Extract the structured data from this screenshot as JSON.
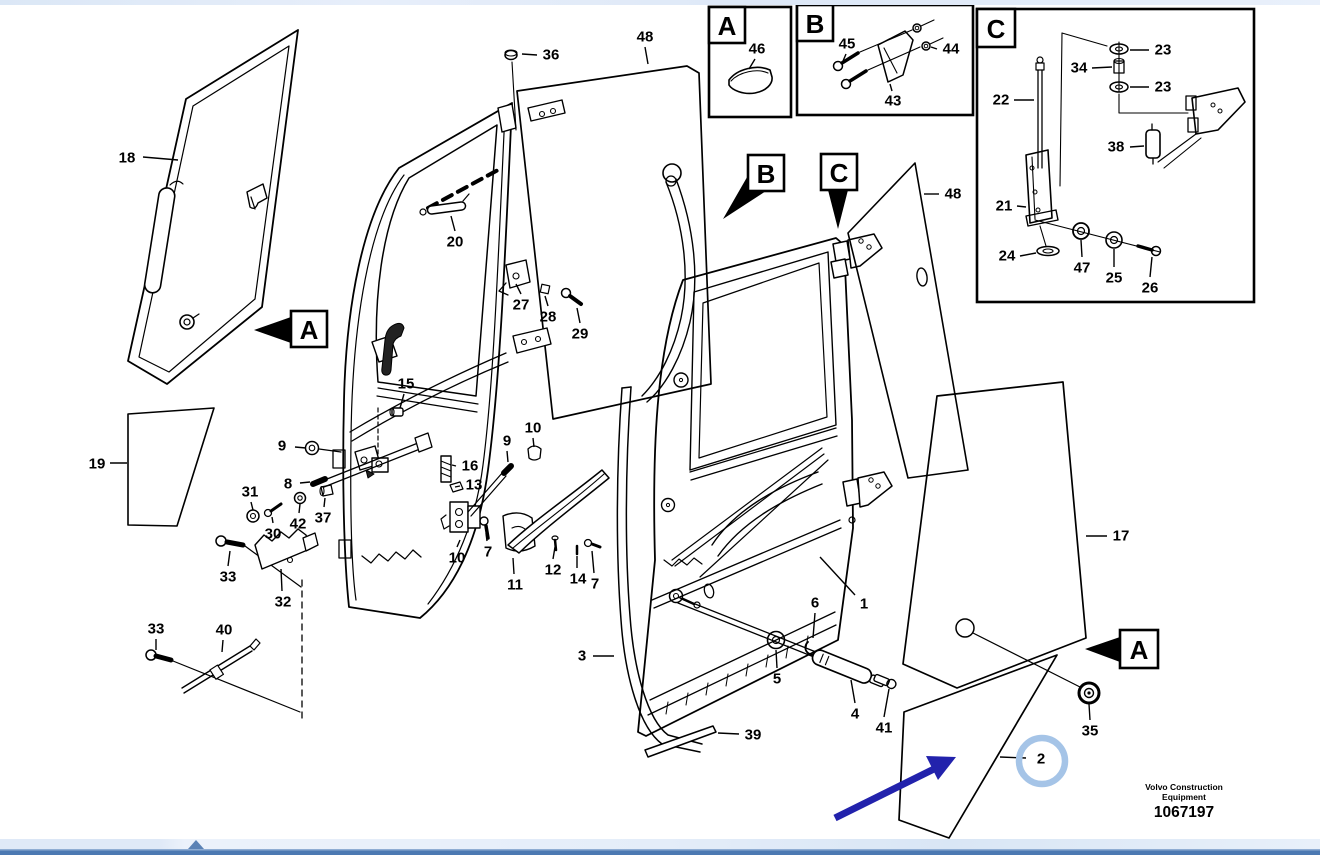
{
  "title": "Door assembly exploded parts diagram",
  "footer": {
    "brand_line1": "Volvo Construction",
    "brand_line2": "Equipment",
    "figure_number": "1067197"
  },
  "colors": {
    "line_art": "#000000",
    "highlight_arrow": "#2222AC",
    "highlight_circle": "#A5C4E7",
    "top_strip": "#DEE9F7",
    "scroll_band": "#E3ECF8",
    "scroll_bar": "#4C79B2",
    "scroll_triangle": "#5B82B5"
  },
  "inset_boxes": [
    {
      "id": "A",
      "letter": "A",
      "frame": [
        709,
        7,
        82,
        110
      ],
      "letter_box": [
        709,
        7,
        36,
        36
      ]
    },
    {
      "id": "B",
      "letter": "B",
      "frame": [
        797,
        5,
        176,
        110
      ],
      "letter_box": [
        797,
        5,
        36,
        36
      ]
    },
    {
      "id": "C",
      "letter": "C",
      "frame": [
        977,
        9,
        277,
        293
      ],
      "letter_box": [
        977,
        9,
        38,
        38
      ]
    }
  ],
  "ref_markers": [
    {
      "id": "A-side",
      "letter": "A",
      "box": [
        291,
        311,
        36,
        36
      ],
      "arrow": "291,317 291,343 254,330"
    },
    {
      "id": "B-main",
      "letter": "B",
      "box": [
        748,
        155,
        36,
        36
      ],
      "arrow": "750,172 766,191 723,219"
    },
    {
      "id": "C-main",
      "letter": "C",
      "box": [
        821,
        154,
        36,
        36
      ],
      "arrow": "828,190 848,190 838,229"
    },
    {
      "id": "A-right",
      "letter": "A",
      "box": [
        1120,
        630,
        38,
        38
      ],
      "arrow": "1120,637 1120,662 1085,649"
    }
  ],
  "part_labels": [
    {
      "id": "18",
      "num": "18",
      "x": 127,
      "y": 158,
      "leader": [
        143,
        157,
        178,
        160
      ]
    },
    {
      "id": "19",
      "num": "19",
      "x": 97,
      "y": 464,
      "leader": [
        110,
        463,
        127,
        463
      ]
    },
    {
      "id": "36",
      "num": "36",
      "x": 551,
      "y": 55,
      "leader": [
        537,
        55,
        522,
        54
      ]
    },
    {
      "id": "48-top",
      "num": "48",
      "x": 645,
      "y": 37,
      "leader": [
        645,
        47,
        648,
        64
      ]
    },
    {
      "id": "20",
      "num": "20",
      "x": 455,
      "y": 242,
      "leader": [
        455,
        231,
        451,
        216
      ]
    },
    {
      "id": "27",
      "num": "27",
      "x": 521,
      "y": 305,
      "leader": [
        521,
        294,
        516,
        284
      ]
    },
    {
      "id": "28",
      "num": "28",
      "x": 548,
      "y": 317,
      "leader": [
        548,
        306,
        545,
        296
      ]
    },
    {
      "id": "29",
      "num": "29",
      "x": 580,
      "y": 334,
      "leader": [
        580,
        323,
        577,
        308
      ]
    },
    {
      "id": "15",
      "num": "15",
      "x": 406,
      "y": 384,
      "leader": [
        404,
        394,
        400,
        408
      ]
    },
    {
      "id": "9-left",
      "num": "9",
      "x": 282,
      "y": 446,
      "leader": [
        295,
        447,
        306,
        448
      ]
    },
    {
      "id": "8",
      "num": "8",
      "x": 288,
      "y": 484,
      "leader": [
        300,
        483,
        310,
        482
      ]
    },
    {
      "id": "31",
      "num": "31",
      "x": 250,
      "y": 492,
      "leader": [
        251,
        502,
        253,
        510
      ]
    },
    {
      "id": "30",
      "num": "30",
      "x": 273,
      "y": 534,
      "leader": [
        273,
        523,
        272,
        517
      ]
    },
    {
      "id": "42",
      "num": "42",
      "x": 298,
      "y": 524,
      "leader": [
        299,
        513,
        300,
        504
      ]
    },
    {
      "id": "37",
      "num": "37",
      "x": 323,
      "y": 518,
      "leader": [
        324,
        507,
        325,
        498
      ]
    },
    {
      "id": "16",
      "num": "16",
      "x": 470,
      "y": 466,
      "leader": [
        456,
        466,
        452,
        465
      ]
    },
    {
      "id": "13",
      "num": "13",
      "x": 474,
      "y": 485,
      "leader": [
        460,
        486,
        455,
        487
      ]
    },
    {
      "id": "9-right",
      "num": "9",
      "x": 507,
      "y": 441,
      "leader": [
        507,
        451,
        508,
        462
      ]
    },
    {
      "id": "10-top",
      "num": "10",
      "x": 533,
      "y": 428,
      "leader": [
        533,
        438,
        534,
        447
      ]
    },
    {
      "id": "10-bottom",
      "num": "10",
      "x": 457,
      "y": 558,
      "leader": [
        457,
        547,
        460,
        540
      ]
    },
    {
      "id": "7-a",
      "num": "7",
      "x": 488,
      "y": 552,
      "leader": [
        487,
        541,
        486,
        533
      ]
    },
    {
      "id": "11",
      "num": "11",
      "x": 515,
      "y": 585,
      "leader": [
        514,
        574,
        513,
        558
      ]
    },
    {
      "id": "12",
      "num": "12",
      "x": 553,
      "y": 570,
      "leader": [
        553,
        559,
        555,
        547
      ]
    },
    {
      "id": "14",
      "num": "14",
      "x": 578,
      "y": 579,
      "leader": [
        577,
        568,
        577,
        556
      ]
    },
    {
      "id": "7-b",
      "num": "7",
      "x": 595,
      "y": 584,
      "leader": [
        594,
        573,
        592,
        551
      ]
    },
    {
      "id": "33-top",
      "num": "33",
      "x": 228,
      "y": 577,
      "leader": [
        228,
        566,
        230,
        551
      ]
    },
    {
      "id": "32",
      "num": "32",
      "x": 283,
      "y": 602,
      "leader": [
        282,
        591,
        281,
        569
      ]
    },
    {
      "id": "33-bottom",
      "num": "33",
      "x": 156,
      "y": 629,
      "leader": [
        156,
        639,
        156,
        650
      ]
    },
    {
      "id": "40",
      "num": "40",
      "x": 224,
      "y": 630,
      "leader": [
        223,
        640,
        222,
        652
      ]
    },
    {
      "id": "3",
      "num": "3",
      "x": 582,
      "y": 656,
      "leader": [
        593,
        656,
        614,
        656
      ]
    },
    {
      "id": "5",
      "num": "5",
      "x": 777,
      "y": 679,
      "leader": [
        777,
        668,
        776,
        650
      ]
    },
    {
      "id": "6",
      "num": "6",
      "x": 815,
      "y": 603,
      "leader": [
        815,
        613,
        813,
        638
      ]
    },
    {
      "id": "1",
      "num": "1",
      "x": 864,
      "y": 604,
      "leader": [
        855,
        595,
        820,
        557
      ]
    },
    {
      "id": "4",
      "num": "4",
      "x": 855,
      "y": 714,
      "leader": [
        855,
        703,
        851,
        680
      ]
    },
    {
      "id": "41",
      "num": "41",
      "x": 884,
      "y": 728,
      "leader": [
        884,
        717,
        889,
        689
      ]
    },
    {
      "id": "39",
      "num": "39",
      "x": 753,
      "y": 735,
      "leader": [
        739,
        734,
        718,
        733
      ]
    },
    {
      "id": "48-right",
      "num": "48",
      "x": 953,
      "y": 194,
      "leader": [
        939,
        194,
        924,
        194
      ]
    },
    {
      "id": "17",
      "num": "17",
      "x": 1121,
      "y": 536,
      "leader": [
        1107,
        536,
        1086,
        536
      ]
    },
    {
      "id": "35",
      "num": "35",
      "x": 1090,
      "y": 731,
      "leader": [
        1090,
        720,
        1089,
        704
      ]
    },
    {
      "id": "2",
      "num": "2",
      "x": 1041,
      "y": 759,
      "leader": [
        1026,
        758,
        1000,
        757
      ]
    },
    {
      "id": "46",
      "num": "46",
      "x": 757,
      "y": 49,
      "leader": [
        755,
        59,
        749,
        69
      ]
    },
    {
      "id": "45",
      "num": "45",
      "x": 847,
      "y": 44,
      "leader": [
        846,
        54,
        843,
        61
      ]
    },
    {
      "id": "44",
      "num": "44",
      "x": 951,
      "y": 49,
      "leader": [
        937,
        49,
        931,
        47
      ]
    },
    {
      "id": "43",
      "num": "43",
      "x": 893,
      "y": 101,
      "leader": [
        892,
        91,
        890,
        84
      ]
    },
    {
      "id": "23-a",
      "num": "23",
      "x": 1163,
      "y": 50,
      "leader": [
        1149,
        50,
        1130,
        50
      ]
    },
    {
      "id": "34",
      "num": "34",
      "x": 1079,
      "y": 68,
      "leader": [
        1092,
        68,
        1112,
        67
      ]
    },
    {
      "id": "23-b",
      "num": "23",
      "x": 1163,
      "y": 87,
      "leader": [
        1149,
        87,
        1130,
        87
      ]
    },
    {
      "id": "22",
      "num": "22",
      "x": 1001,
      "y": 100,
      "leader": [
        1014,
        100,
        1034,
        100
      ]
    },
    {
      "id": "38",
      "num": "38",
      "x": 1116,
      "y": 147,
      "leader": [
        1130,
        147,
        1144,
        146
      ]
    },
    {
      "id": "21",
      "num": "21",
      "x": 1004,
      "y": 206,
      "leader": [
        1017,
        206,
        1026,
        207
      ]
    },
    {
      "id": "24",
      "num": "24",
      "x": 1007,
      "y": 256,
      "leader": [
        1020,
        256,
        1036,
        253
      ]
    },
    {
      "id": "47",
      "num": "47",
      "x": 1082,
      "y": 268,
      "leader": [
        1082,
        257,
        1081,
        240
      ]
    },
    {
      "id": "25",
      "num": "25",
      "x": 1114,
      "y": 278,
      "leader": [
        1114,
        267,
        1114,
        249
      ]
    },
    {
      "id": "26",
      "num": "26",
      "x": 1150,
      "y": 288,
      "leader": [
        1150,
        277,
        1152,
        257
      ]
    }
  ],
  "annotations": {
    "arrow": {
      "x1": 835,
      "y1": 818,
      "x2": 936,
      "y2": 768,
      "head": "956,757 926,756 938,780",
      "color": "#2222AC",
      "width": 7
    },
    "circle": {
      "cx": 1042,
      "cy": 761,
      "r": 23,
      "color": "#A5C4E7",
      "stroke_width": 6.5,
      "around_part": "2"
    }
  }
}
